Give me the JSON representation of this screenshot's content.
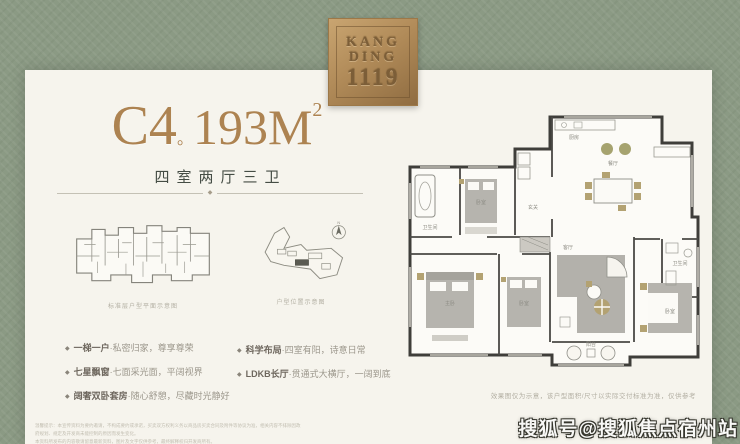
{
  "brand": {
    "logo_line1": "KANG",
    "logo_line2": "DING",
    "logo_line3": "1119"
  },
  "header": {
    "unit": "C4",
    "dot": "。",
    "area": "193M",
    "area_sup": "2",
    "subtitle": "四室两厅三卫",
    "divider_diamond": "◆"
  },
  "mini_diagrams": {
    "floor_plan_caption": "标准层户型平面示意图",
    "site_plan_caption": "户型位置示意图",
    "north_label": "N"
  },
  "features": {
    "marker": "◆",
    "col1": [
      {
        "title": "一梯一户",
        "desc": "·私密归家，尊享尊荣"
      },
      {
        "title": "七星飘窗",
        "desc": "·七面采光面，平阔视界"
      },
      {
        "title": "阔奢双卧套房",
        "desc": "·随心舒憩，尽藏时光静好"
      }
    ],
    "col2": [
      {
        "title": "科学布局",
        "desc": "·四室有阳，诗意日常"
      },
      {
        "title": "LDKB长厅",
        "desc": "·贯通式大横厅，一阔到底"
      }
    ]
  },
  "floorplan": {
    "caption": "效果图仅为示意，该户型面积/尺寸以实际交付标准为准，仅供参考",
    "rooms": {
      "entry": "玄关",
      "kitchen": "厨房",
      "dining": "餐厅",
      "living": "客厅",
      "master": "主卧",
      "bedroom_b": "卧室",
      "bedroom_c": "卧室",
      "bedroom_d": "卧室",
      "bath_a": "卫生间",
      "bath_b": "卫生间",
      "balcony": "阳台"
    }
  },
  "footer": {
    "disclaimer_line1": "温馨提示：本宣传资料为要约邀请，不构成要约或承诺，买卖双方权利义务以商品房买卖合同及附件等协议为准，相关内容不排除因政府规划、规定及开发商未能控制的原因而发生变化。",
    "disclaimer_line2": "本资料所发布的内容敬请留意最新资料，图片及文字仅供参考，最终解释权归开发商所有。",
    "watermark": "搜狐号@搜狐焦点宿州站"
  },
  "colors": {
    "background": "#8b9a84",
    "card": "#f6f4ed",
    "accent_gold": "#ad8351",
    "wall": "#3f3e3a",
    "furniture_gray": "#b6b4ae",
    "accent_tan": "#b3a272"
  }
}
